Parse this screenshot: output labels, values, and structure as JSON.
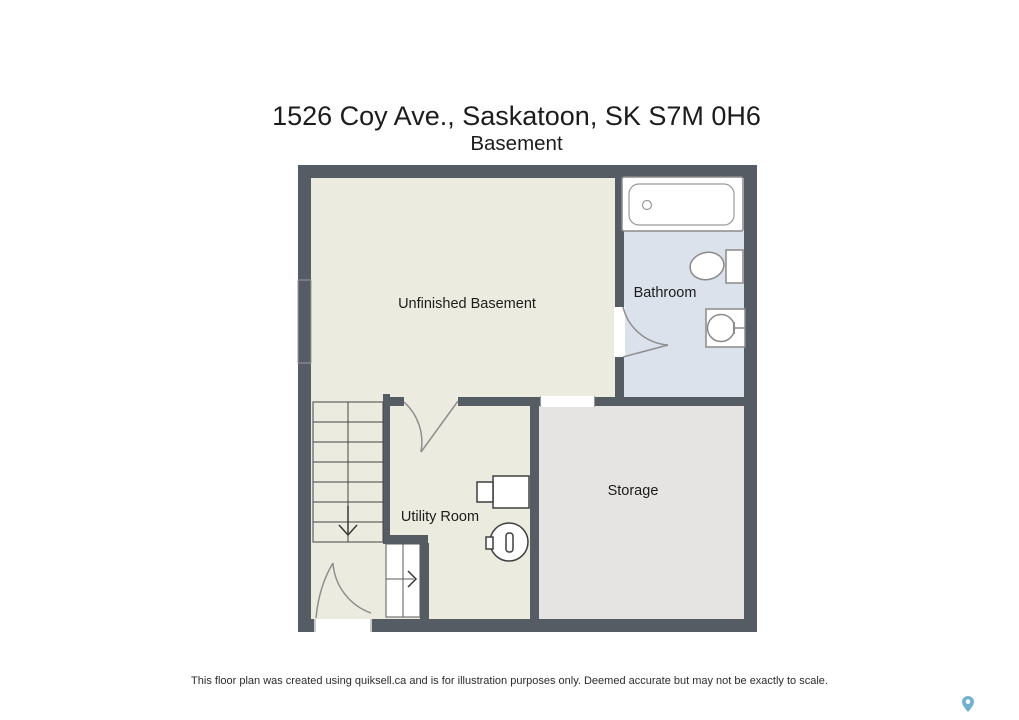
{
  "page": {
    "title": "1526 Coy Ave., Saskatoon, SK S7M 0H6",
    "subtitle": "Basement",
    "disclaimer": "This floor plan was created using quiksell.ca and is for illustration purposes only. Deemed accurate but may not be exactly to scale."
  },
  "floorplan": {
    "rooms": [
      {
        "name": "Unfinished Basement"
      },
      {
        "name": "Bathroom"
      },
      {
        "name": "Storage"
      },
      {
        "name": "Utility Room"
      }
    ],
    "fixtures": [
      "bathtub",
      "toilet",
      "sink",
      "washer",
      "water-heater",
      "staircase-down",
      "closet-stair-right",
      "entry-door",
      "interior-doors",
      "window",
      "cased-opening"
    ],
    "icons": {
      "map_pin": "map-pin-icon"
    }
  },
  "colors": {
    "wall": "#565c63",
    "room-beige": "#ecebdf",
    "room-blue": "#dce2ec",
    "room-gray": "#e5e4e2",
    "fixture-line": "#8a8a8a",
    "appliance-line": "#3f3f3f",
    "text": "#1c1c1c",
    "footer-text": "#2b2b2b",
    "pin-blue": "#62a8ca"
  }
}
